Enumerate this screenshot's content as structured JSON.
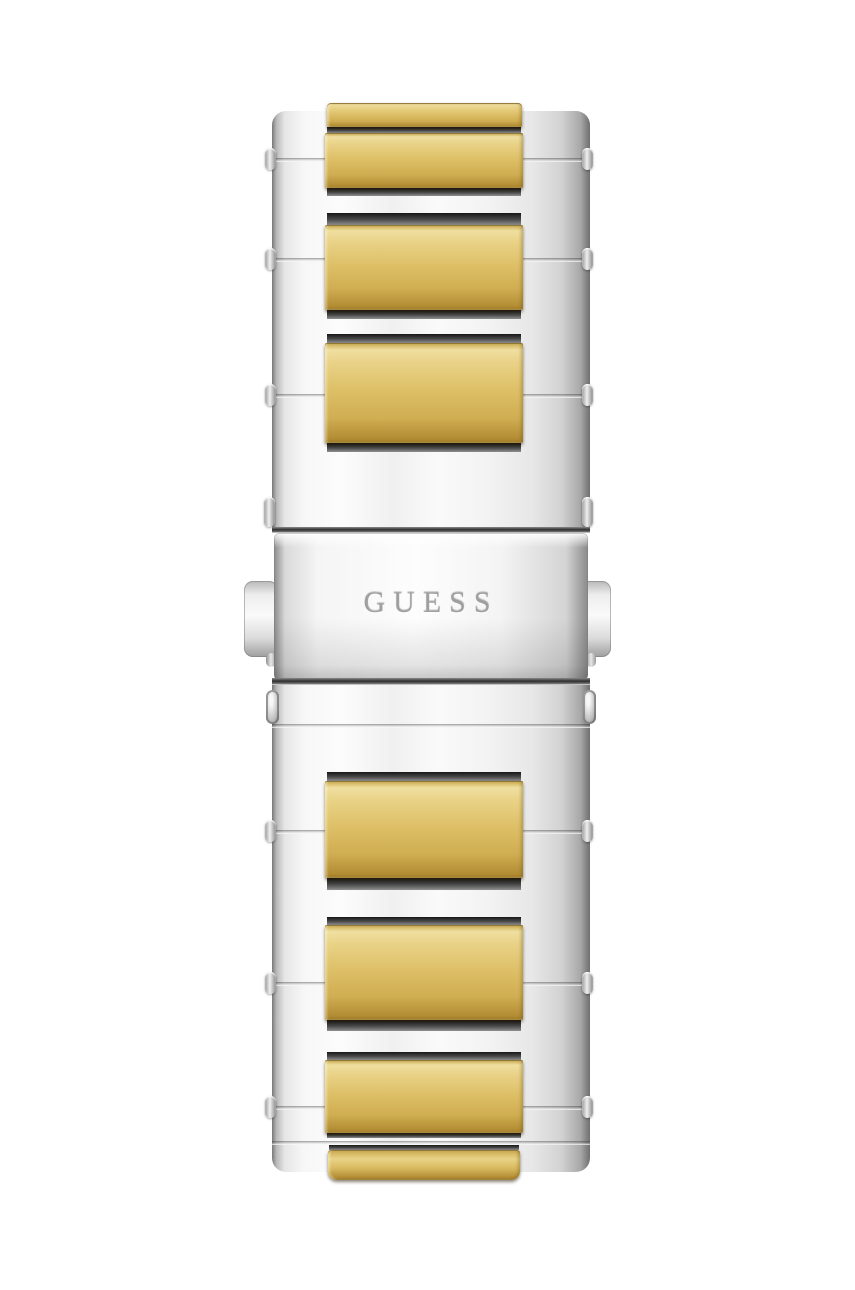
{
  "product": {
    "brand_engraving": "GUESS"
  },
  "colors": {
    "background": "#ffffff",
    "gold_light": "#f0dfa0",
    "gold": "#ddbf66",
    "gold_dark": "#b28c33",
    "silver_light": "#fbfbfb",
    "silver": "#e9e9e9",
    "silver_edge": "#7e7e7e",
    "recess_shadow": "#2a2a2a",
    "engraving": "#9f9f9f"
  }
}
